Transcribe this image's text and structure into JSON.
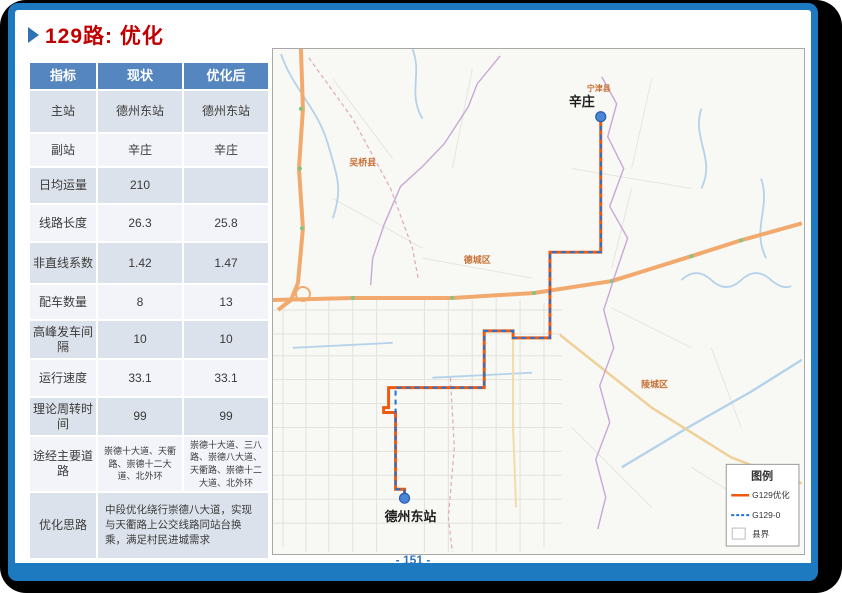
{
  "slide": {
    "title": "129路: 优化",
    "page_number": "- 151 -"
  },
  "table": {
    "headers": [
      "指标",
      "现状",
      "优化后"
    ],
    "rows": [
      {
        "label": "主站",
        "current": "德州东站",
        "optimized": "德州东站"
      },
      {
        "label": "副站",
        "current": "辛庄",
        "optimized": "辛庄"
      },
      {
        "label": "日均运量",
        "current": "210",
        "optimized": ""
      },
      {
        "label": "线路长度",
        "current": "26.3",
        "optimized": "25.8"
      },
      {
        "label": "非直线系数",
        "current": "1.42",
        "optimized": "1.47"
      },
      {
        "label": "配车数量",
        "current": "8",
        "optimized": "13"
      },
      {
        "label": "高峰发车间隔",
        "current": "10",
        "optimized": "10"
      },
      {
        "label": "运行速度",
        "current": "33.1",
        "optimized": "33.1"
      },
      {
        "label": "理论周转时间",
        "current": "99",
        "optimized": "99"
      },
      {
        "label": "途经主要道路",
        "current": "崇德十大道、天衢路、崇德十二大道、北外环",
        "optimized": "崇德十大道、三八路、崇德八大道、天衢路、崇德十二大道、北外环"
      },
      {
        "label": "优化思路",
        "merged": "中段优化绕行崇德八大道，实现与天衢路上公交线路同站台换乘，满足村民进城需求"
      }
    ]
  },
  "map": {
    "stations": [
      {
        "name": "辛庄"
      },
      {
        "name": "德州东站"
      }
    ],
    "region_labels": [
      "宁津县",
      "吴桥县",
      "德城区",
      "陵城区"
    ],
    "legend": {
      "title": "图例",
      "items": [
        {
          "label": "G129优化",
          "style": "solid-orange-line"
        },
        {
          "label": "G129-0",
          "style": "dashed-blue-line"
        },
        {
          "label": "县界",
          "style": "county-boundary-box"
        }
      ]
    }
  },
  "colors": {
    "frame_blue": "#1D7AC0",
    "title_red": "#C00000",
    "table_header_blue": "#5586C0",
    "route_optimized_orange": "#EE5A0E",
    "route_original_blue": "#1C74D9",
    "page_number_blue": "#2E74B5",
    "region_label_orange": "#C87137"
  }
}
